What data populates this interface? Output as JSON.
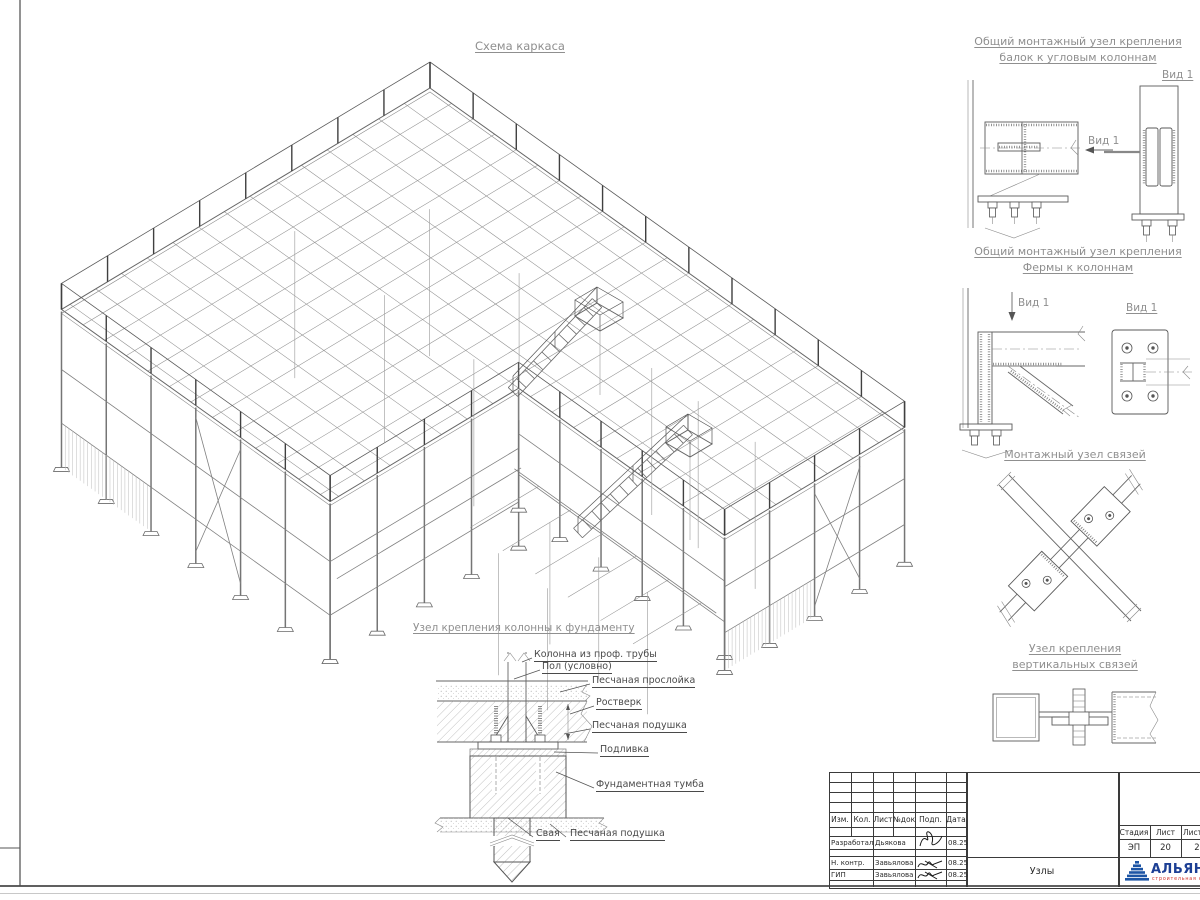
{
  "drawing": {
    "main_title": "Схема каркаса",
    "details": {
      "corner_beam": {
        "title_line1": "Общий монтажный узел крепления",
        "title_line2": "балок к угловым колоннам",
        "arrow_view_label": "Вид 1",
        "view_title": "Вид 1"
      },
      "truss_column": {
        "title_line1": "Общий монтажный узел крепления",
        "title_line2": "Фермы к колоннам",
        "arrow_view_label": "Вид 1",
        "view_title": "Вид 1"
      },
      "braces": {
        "title": "Монтажный узел связей"
      },
      "vertical_braces": {
        "title_line1": "Узел крепления",
        "title_line2": "вертикальных связей"
      },
      "foundation": {
        "title": "Узел крепления колонны к фундаменту",
        "labels": {
          "column": "Колонна из проф. трубы",
          "floor": "Пол (условно)",
          "sand_layer": "Песчаная прослойка",
          "grillage": "Ростверк",
          "sand_cushion": "Песчаная подушка",
          "grout": "Подливка",
          "pedestal": "Фундаментная тумба",
          "pile": "Свая",
          "sand_cushion_2": "Песчаная подушка"
        }
      }
    }
  },
  "title_block": {
    "revision_headers": [
      "Изм.",
      "Кол.",
      "Лист",
      "№док",
      "Подп.",
      "Дата"
    ],
    "signature_rows": [
      {
        "role": "Разработал",
        "name": "Дьякова",
        "date": "08.25"
      },
      {
        "role": "Н. контр.",
        "name": "Завьялова",
        "date": "08.25"
      },
      {
        "role": "ГИП",
        "name": "Завьялова",
        "date": "08.25"
      }
    ],
    "stage_headers": [
      "Стадия",
      "Лист",
      "Листов"
    ],
    "stage_values": [
      "ЭП",
      "20",
      "2"
    ],
    "document_name": "Узлы",
    "company": {
      "name": "АЛЬЯНС",
      "tagline": "строительная компания"
    },
    "colors": {
      "logo_blue": "#1d55a5",
      "logo_text_blue": "#1c3f94",
      "logo_red": "#d03027"
    }
  }
}
